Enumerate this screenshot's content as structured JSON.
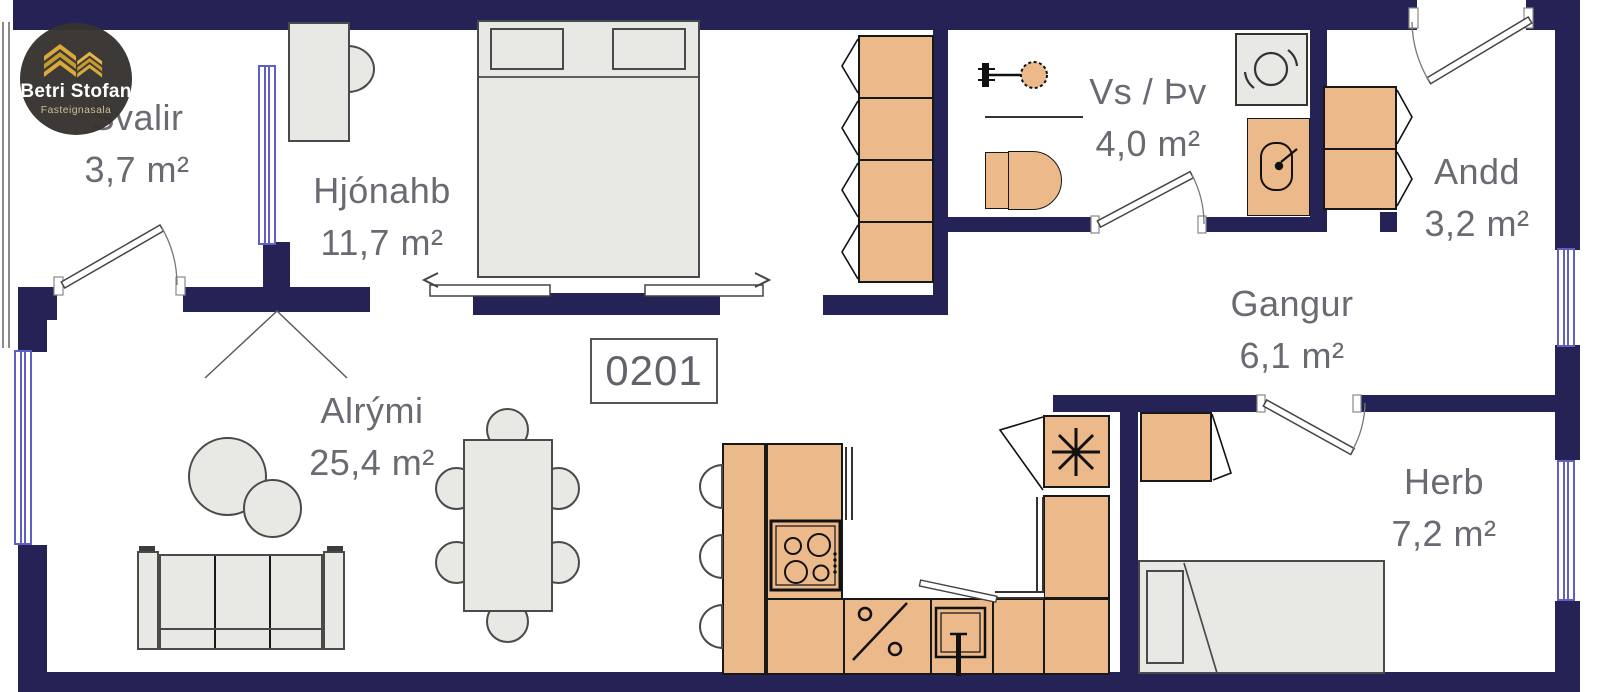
{
  "unit": {
    "number": "0201"
  },
  "logo": {
    "title": "Betri Stofan",
    "subtitle": "Fasteignasala"
  },
  "rooms": [
    {
      "name": "Svalir",
      "area": "3,7 m²"
    },
    {
      "name": "Hjónahb",
      "area": "11,7 m²"
    },
    {
      "name": "Vs / Þv",
      "area": "4,0 m²"
    },
    {
      "name": "Andd",
      "area": "3,2 m²"
    },
    {
      "name": "Gangur",
      "area": "6,1 m²"
    },
    {
      "name": "Alrými",
      "area": "25,4 m²"
    },
    {
      "name": "Herb",
      "area": "7,2 m²"
    }
  ],
  "colors": {
    "wall": "#252355",
    "wood": "#ecb98b",
    "furniture": "#e8e8e5",
    "window": "#5f5fc5",
    "label": "#6a6a73",
    "logo_gold": "#d9a93c"
  },
  "icons": {
    "stove": "four-burner-cooktop",
    "dishwasher": "percent-symbol",
    "kitchen_sink": "square-basin-with-tap",
    "fridge": "snowflake",
    "washing_machine": "drum-swirl",
    "shower": "shower-head",
    "toilet": "toilet-cistern-and-bowl",
    "bathroom_sink": "basin-with-lever",
    "logo_icon": "gold-building-chevrons"
  }
}
